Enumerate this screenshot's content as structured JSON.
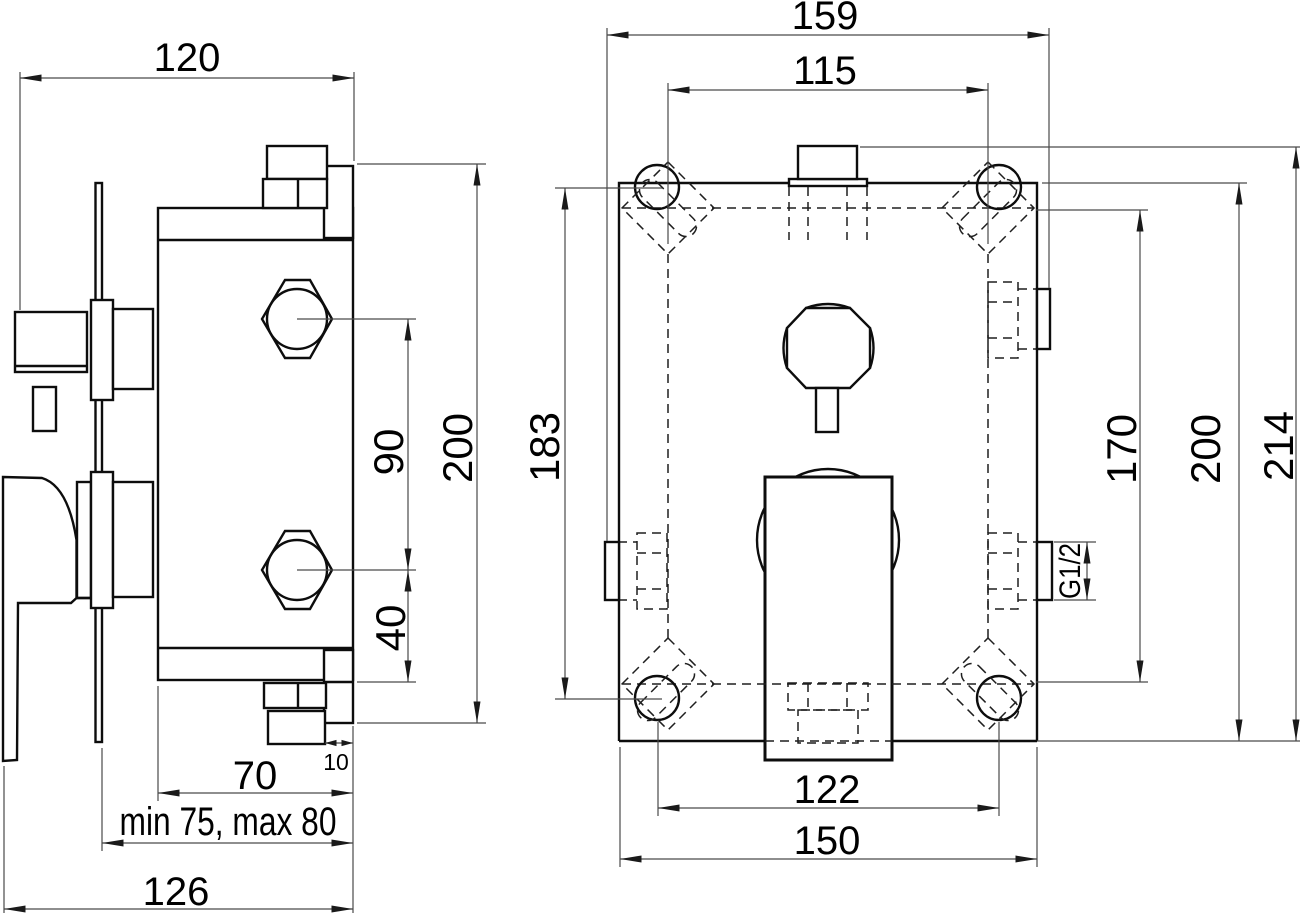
{
  "drawing": {
    "type": "technical-installation-drawing",
    "background": "#ffffff",
    "line_color": "#0d0d0d",
    "views": [
      {
        "id": "left",
        "description": "side view of concealed mixer body with lever handle, wall plate and hex pipe unions"
      },
      {
        "id": "right",
        "description": "front view of mounting box with four corner screw slots, diverter knob, square cover plate and G1/2 side ports"
      }
    ]
  },
  "dims": {
    "left": {
      "pipe_to_wall": "120",
      "outlet_spacing": "90",
      "fitting_height": "200",
      "outlet_to_bottom": "40",
      "wall_offset": "10",
      "body_depth": "70",
      "plaster_range": "min 75, max 80",
      "total_depth": "126"
    },
    "right": {
      "total_width": "159",
      "top_slot_spacing": "115",
      "hole_height_spacing": "183",
      "slot_height_spacing": "170",
      "box_height": "200",
      "total_height": "214",
      "bottom_hole_spacing": "122",
      "box_width": "150",
      "thread_size": "G1/2"
    }
  }
}
